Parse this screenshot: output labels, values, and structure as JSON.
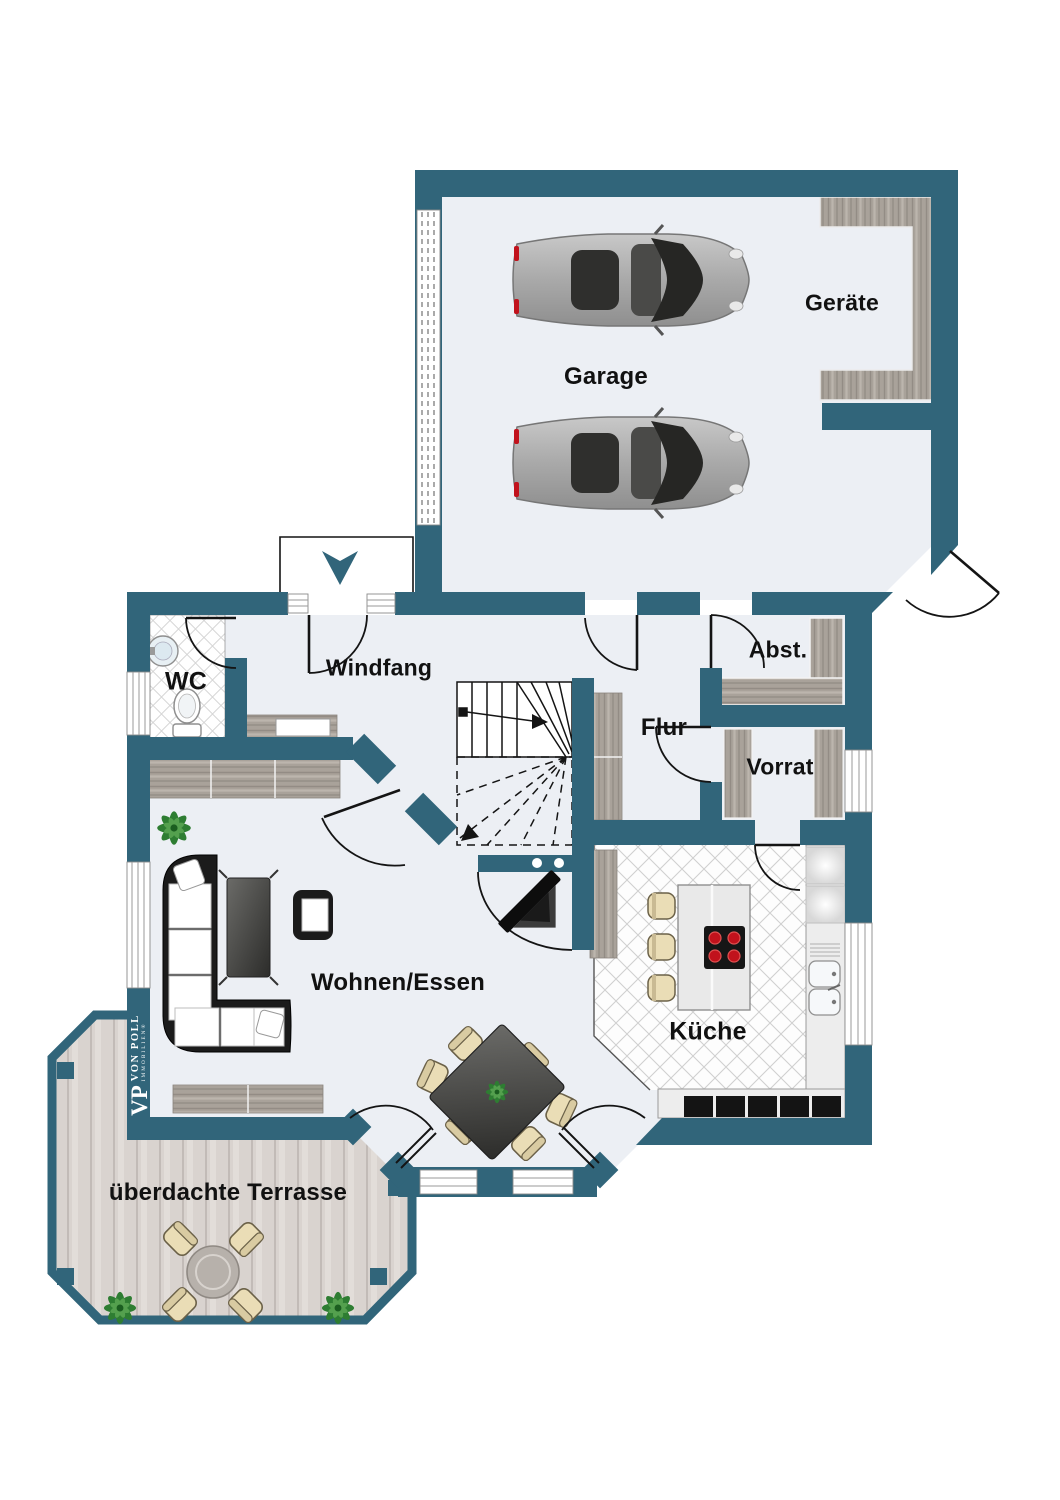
{
  "rooms": {
    "garage": {
      "label": "Garage"
    },
    "geraete": {
      "label": "Geräte"
    },
    "wc": {
      "label": "WC"
    },
    "windfang": {
      "label": "Windfang"
    },
    "flur": {
      "label": "Flur"
    },
    "abst": {
      "label": "Abst."
    },
    "vorrat": {
      "label": "Vorrat"
    },
    "wohnen": {
      "label": "Wohnen/Essen"
    },
    "kueche": {
      "label": "Küche"
    },
    "terrasse": {
      "label": "überdachte Terrasse"
    }
  },
  "logo": {
    "monogram": "VP",
    "name": "VON POLL",
    "sub": "IMMOBILIEN®"
  },
  "colors": {
    "wall": "#31657A",
    "floor": "#ECEFF4",
    "deck": "#D9D3CF",
    "wood": "#A9A29A",
    "tile_line": "#D6D6D6",
    "burner_red": "#C1121C",
    "plant_green": "#2E7D32",
    "car_gray": "#A9A9A9",
    "label_text": "#111111"
  }
}
